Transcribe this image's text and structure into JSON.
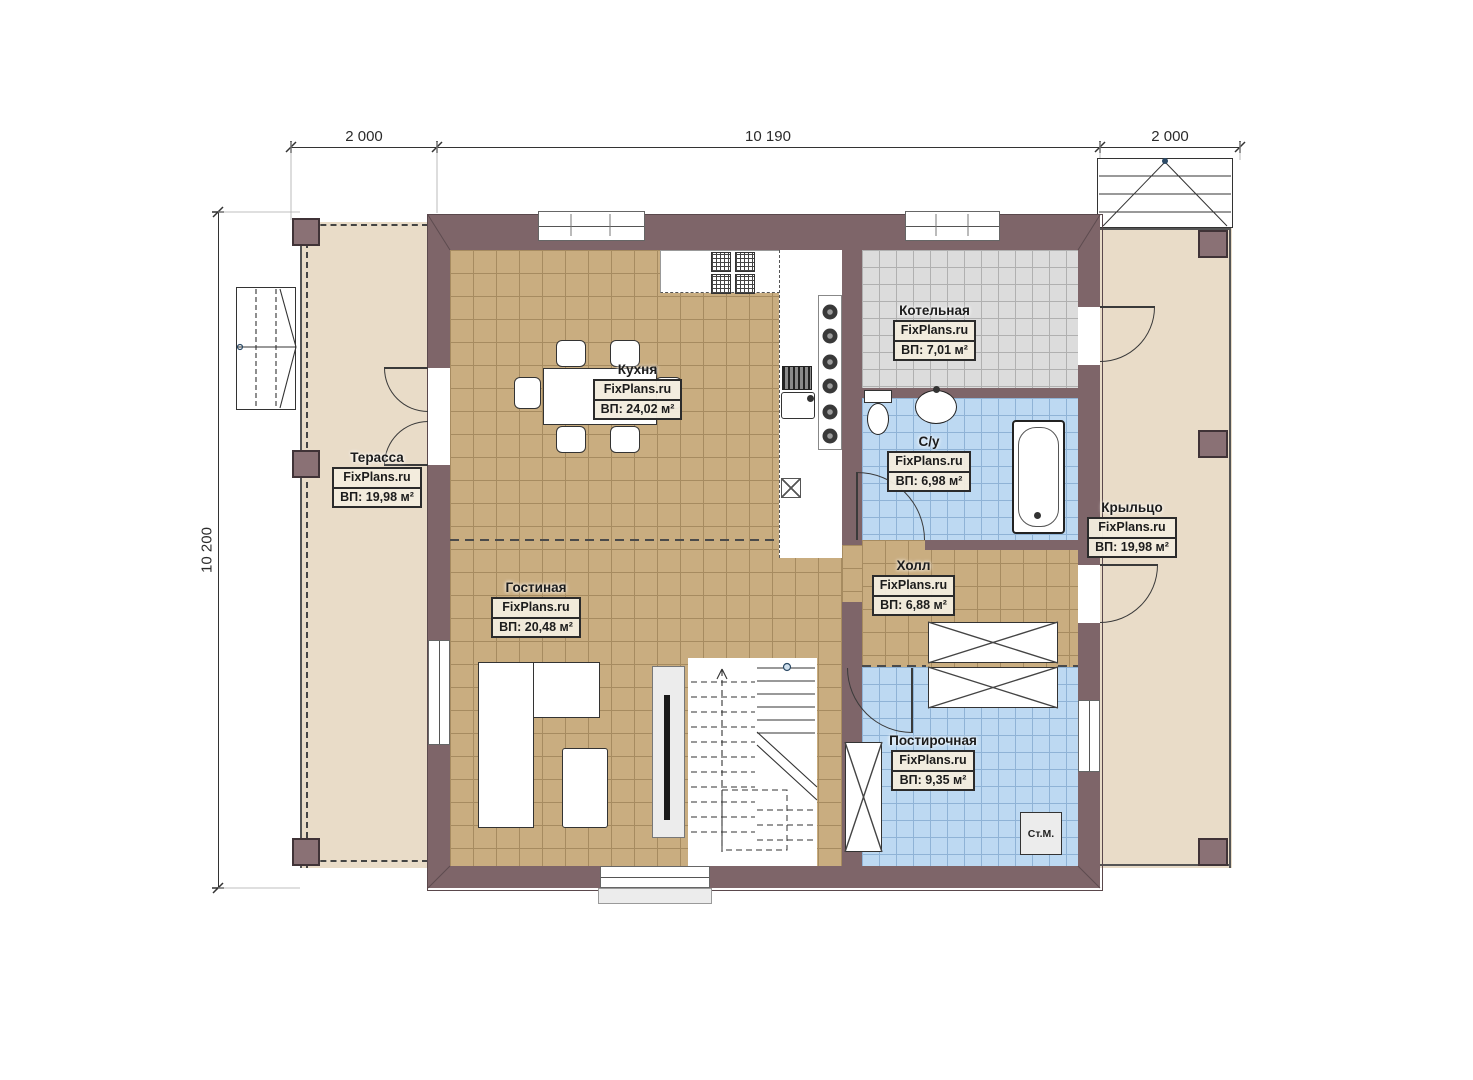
{
  "plan": {
    "dimensions": {
      "top": [
        "2 000",
        "10 190",
        "2 000"
      ],
      "left": "10 200"
    },
    "rooms": [
      {
        "id": "terrace",
        "name": "Терасса",
        "watermark": "FixPlans.ru",
        "area": "ВП: 19,98 м²"
      },
      {
        "id": "kitchen",
        "name": "Кухня",
        "watermark": "FixPlans.ru",
        "area": "ВП: 24,02 м²"
      },
      {
        "id": "boiler",
        "name": "Котельная",
        "watermark": "FixPlans.ru",
        "area": "ВП: 7,01 м²"
      },
      {
        "id": "bathroom",
        "name": "С/у",
        "watermark": "FixPlans.ru",
        "area": "ВП: 6,98 м²"
      },
      {
        "id": "porch",
        "name": "Крыльцо",
        "watermark": "FixPlans.ru",
        "area": "ВП: 19,98 м²"
      },
      {
        "id": "hall",
        "name": "Холл",
        "watermark": "FixPlans.ru",
        "area": "ВП: 6,88 м²"
      },
      {
        "id": "living",
        "name": "Гостиная",
        "watermark": "FixPlans.ru",
        "area": "ВП: 20,48 м²"
      },
      {
        "id": "laundry",
        "name": "Постирочная",
        "watermark": "FixPlans.ru",
        "area": "ВП: 9,35 м²"
      }
    ],
    "appliances": {
      "washing_machine": "Ст.М."
    },
    "colors": {
      "wall": "#7e6569",
      "tile_floor": "#c9ad80",
      "outdoor_floor": "#e9dcc8",
      "wet_floor": "#bdd9f2",
      "boiler_floor": "#dcdcdc"
    }
  }
}
